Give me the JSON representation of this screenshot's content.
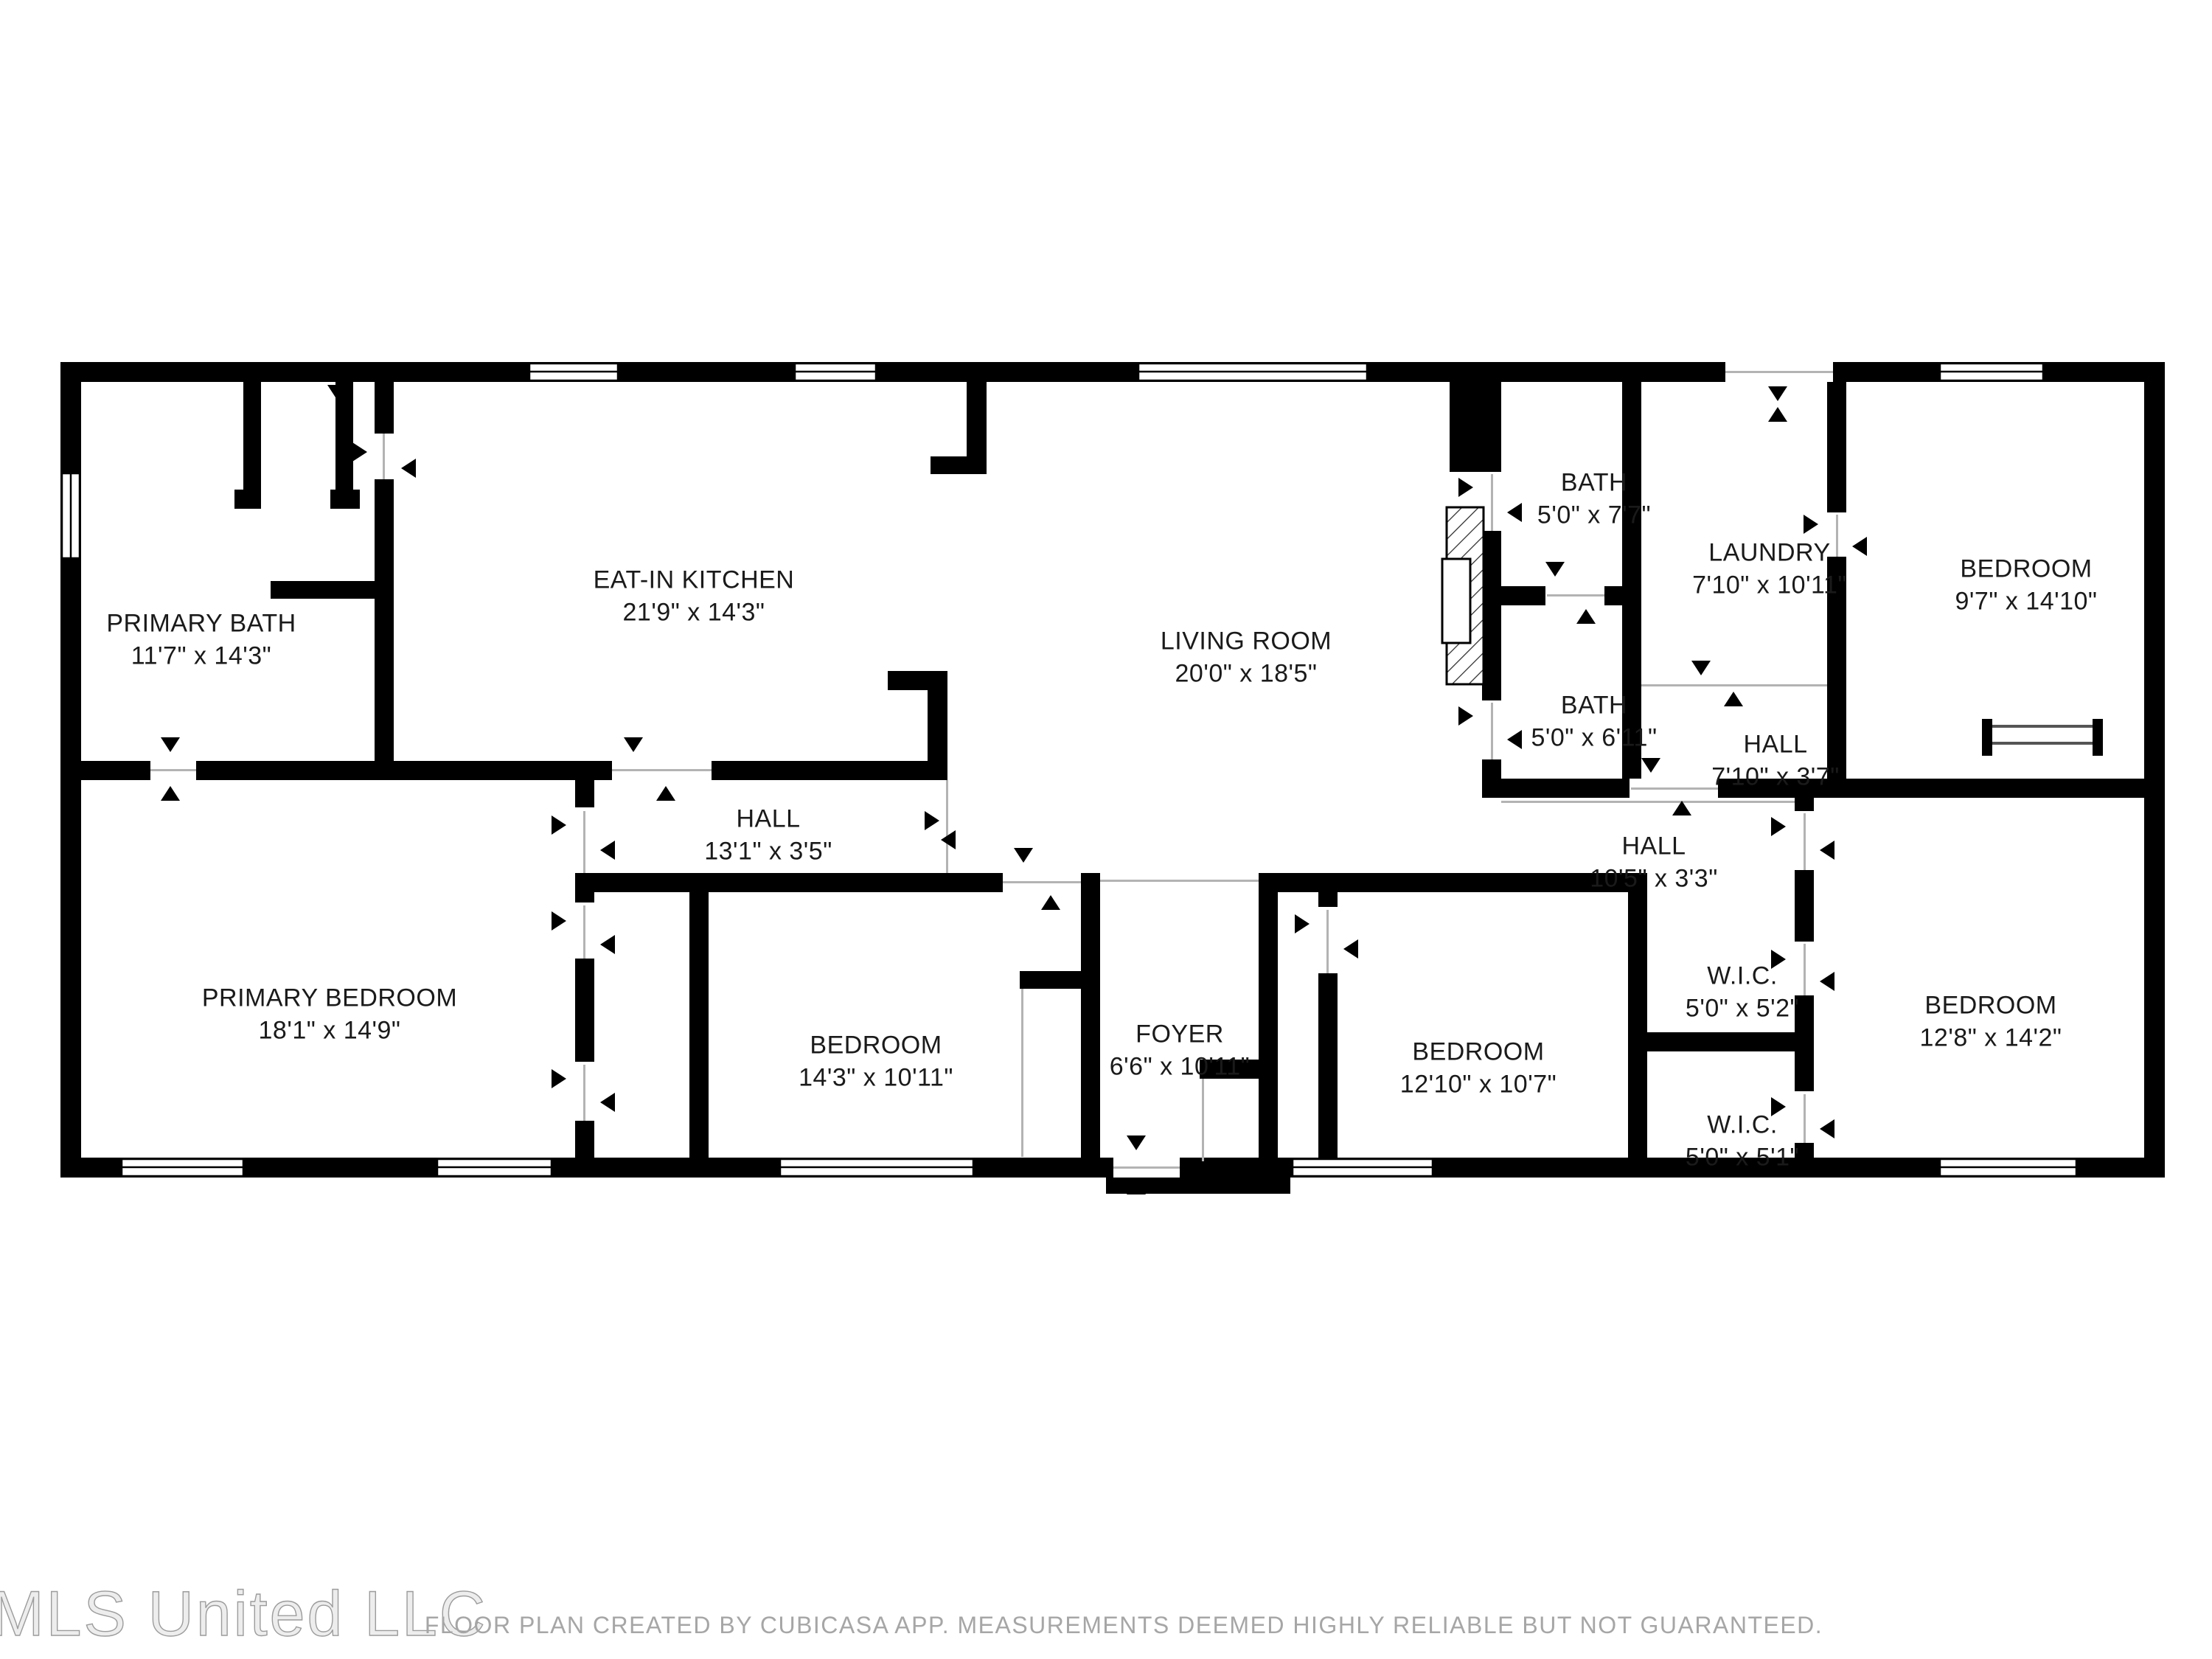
{
  "rooms": [
    {
      "name": "PRIMARY BATH",
      "dims": "11'7\" x 14'3\""
    },
    {
      "name": "EAT-IN KITCHEN",
      "dims": "21'9\" x 14'3\""
    },
    {
      "name": "LIVING ROOM",
      "dims": "20'0\" x 18'5\""
    },
    {
      "name": "BATH",
      "dims": "5'0\" x 7'7\""
    },
    {
      "name": "LAUNDRY",
      "dims": "7'10\" x 10'11\""
    },
    {
      "name": "BEDROOM",
      "dims": "9'7\" x 14'10\""
    },
    {
      "name": "BATH",
      "dims": "5'0\" x 6'11\""
    },
    {
      "name": "HALL",
      "dims": "7'10\" x 3'7\""
    },
    {
      "name": "HALL",
      "dims": "13'1\" x 3'5\""
    },
    {
      "name": "HALL",
      "dims": "10'5\" x 3'3\""
    },
    {
      "name": "PRIMARY BEDROOM",
      "dims": "18'1\" x 14'9\""
    },
    {
      "name": "BEDROOM",
      "dims": "14'3\" x 10'11\""
    },
    {
      "name": "FOYER",
      "dims": "6'6\" x 10'11\""
    },
    {
      "name": "BEDROOM",
      "dims": "12'10\" x 10'7\""
    },
    {
      "name": "W.I.C.",
      "dims": "5'0\" x 5'2\""
    },
    {
      "name": "W.I.C.",
      "dims": "5'0\" x 5'1\""
    },
    {
      "name": "BEDROOM",
      "dims": "12'8\" x 14'2\""
    }
  ],
  "footer": {
    "watermark": "MLS United LLC",
    "disclaimer": "FLOOR PLAN CREATED BY CUBICASA APP. MEASUREMENTS DEEMED HIGHLY RELIABLE BUT NOT GUARANTEED."
  },
  "colors": {
    "wall": "#000000",
    "label": "#1a1a1a",
    "watermark_stroke": "#9c9c9c",
    "disclaimer": "#a6a6a6"
  }
}
